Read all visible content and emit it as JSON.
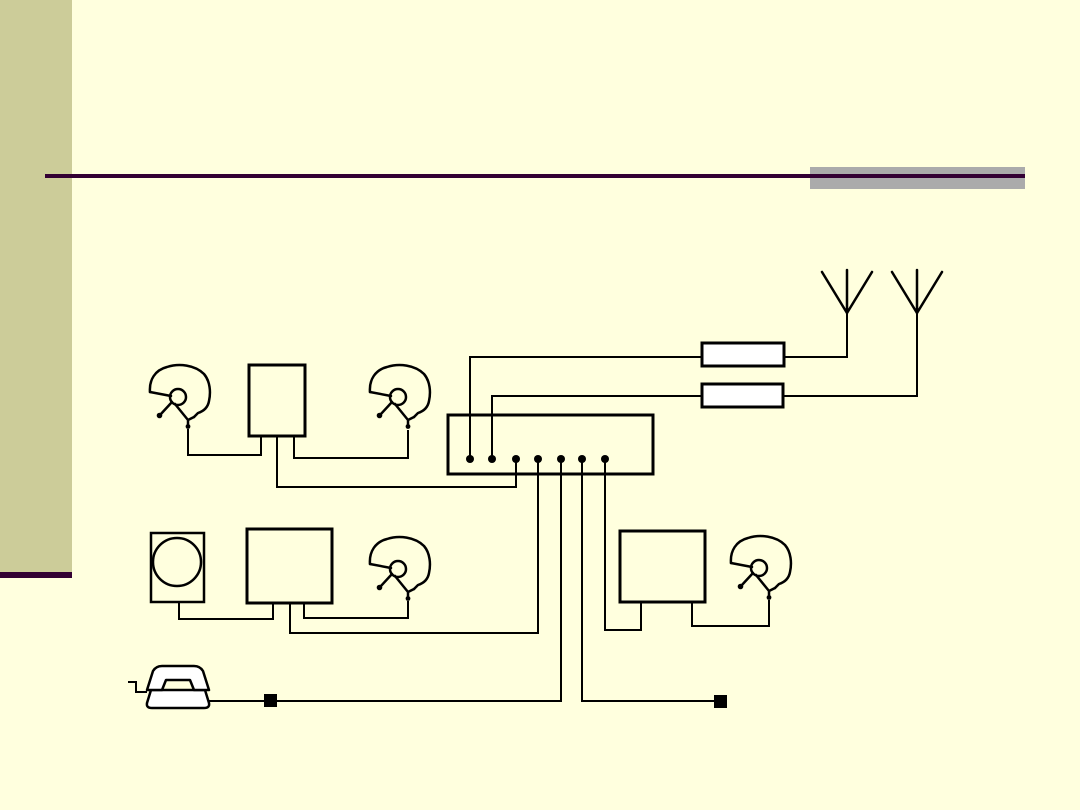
{
  "colors": {
    "background": "#FFFFDE",
    "sidebar": "#CCCC99",
    "accent": "#330033",
    "gray_bar": "#ABABAB",
    "line": "#000000",
    "shape_fill": "#FFFFFF"
  },
  "diagram": {
    "nodes": [
      {
        "id": "headset-1",
        "type": "helmet-headset-icon"
      },
      {
        "id": "box-top",
        "type": "equipment-box"
      },
      {
        "id": "headset-2",
        "type": "helmet-headset-icon"
      },
      {
        "id": "intercom-unit",
        "type": "junction-box",
        "port_dots": 7
      },
      {
        "id": "filter-box-1",
        "type": "small-rectangle"
      },
      {
        "id": "filter-box-2",
        "type": "small-rectangle"
      },
      {
        "id": "antenna-1",
        "type": "antenna-icon"
      },
      {
        "id": "antenna-2",
        "type": "antenna-icon"
      },
      {
        "id": "speaker-box",
        "type": "loudspeaker-icon"
      },
      {
        "id": "box-left",
        "type": "equipment-box"
      },
      {
        "id": "headset-3",
        "type": "helmet-headset-icon"
      },
      {
        "id": "box-right",
        "type": "equipment-box"
      },
      {
        "id": "headset-4",
        "type": "helmet-headset-icon"
      },
      {
        "id": "telephone",
        "type": "telephone-icon"
      },
      {
        "id": "connector-1",
        "type": "black-square-connector"
      },
      {
        "id": "connector-2",
        "type": "black-square-connector"
      }
    ],
    "connections": [
      {
        "from": "headset-1",
        "to": "box-top"
      },
      {
        "from": "box-top",
        "to": "headset-2"
      },
      {
        "from": "box-top",
        "to": "intercom-unit",
        "port": 3
      },
      {
        "from": "intercom-unit",
        "to": "filter-box-1",
        "port": 1
      },
      {
        "from": "filter-box-1",
        "to": "antenna-1"
      },
      {
        "from": "intercom-unit",
        "to": "filter-box-2",
        "port": 2
      },
      {
        "from": "filter-box-2",
        "to": "antenna-2"
      },
      {
        "from": "speaker-box",
        "to": "box-left"
      },
      {
        "from": "box-left",
        "to": "headset-3"
      },
      {
        "from": "box-left",
        "to": "intercom-unit",
        "port": 4
      },
      {
        "from": "telephone",
        "to": "intercom-unit",
        "port": 5,
        "via": "connector-1"
      },
      {
        "from": "intercom-unit",
        "to": "connector-2",
        "port": 6
      },
      {
        "from": "intercom-unit",
        "to": "box-right",
        "port": 7
      },
      {
        "from": "box-right",
        "to": "headset-4"
      }
    ]
  }
}
